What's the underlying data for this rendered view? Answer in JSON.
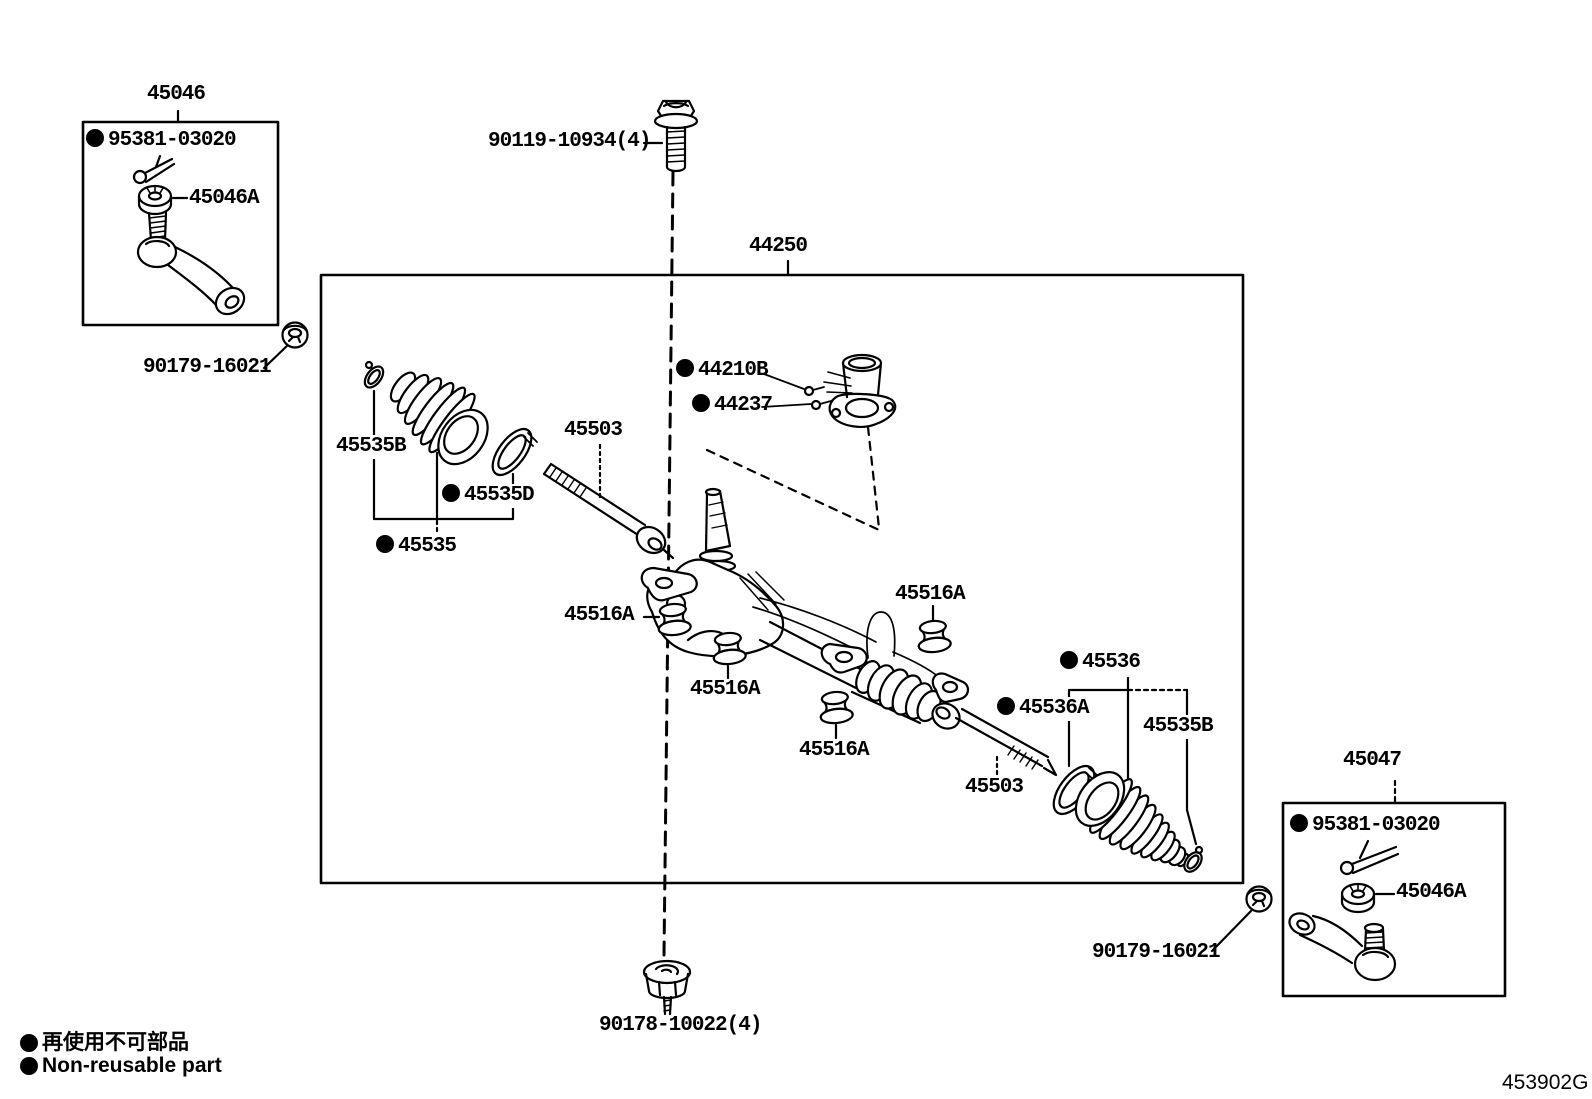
{
  "figure": {
    "code": "453902G"
  },
  "legend": {
    "jp": "再使用不可部品",
    "en": "Non-reusable part"
  },
  "assemblies": {
    "tie_rod_left": {
      "title": "45046"
    },
    "steering_gear": {
      "title": "44250"
    },
    "tie_rod_right": {
      "title": "45047"
    }
  },
  "parts": {
    "p95381_left": "95381-03020",
    "p45046A_left": "45046A",
    "p90179_left": "90179-16021",
    "p90119": "90119-10934(4)",
    "p44210B": "44210B",
    "p44237": "44237",
    "p45535B_left": "45535B",
    "p45535D": "45535D",
    "p45535": "45535",
    "p45503_left": "45503",
    "p45516A_a": "45516A",
    "p45516A_b": "45516A",
    "p45516A_c": "45516A",
    "p45516A_d": "45516A",
    "p45536": "45536",
    "p45536A": "45536A",
    "p45535B_right": "45535B",
    "p45503_right": "45503",
    "p95381_right": "95381-03020",
    "p45046A_right": "45046A",
    "p90179_right": "90179-16021",
    "p90178": "90178-10022(4)"
  },
  "colors": {
    "line": "#000000",
    "background": "#ffffff"
  }
}
